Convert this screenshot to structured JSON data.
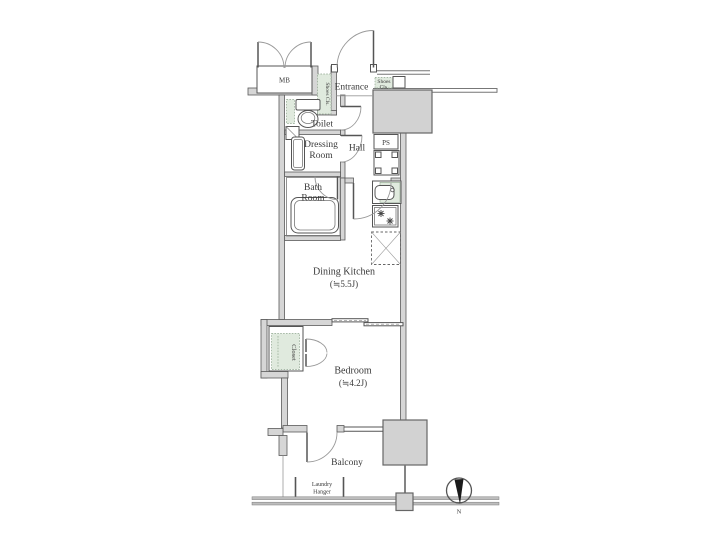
{
  "title": "Apartment floor plan",
  "labels": {
    "mb": "MB",
    "entrance": "Entrance",
    "shoes_left": "Shoes Cls.",
    "shoes_right_1": "Shoes",
    "shoes_right_2": "Cls.",
    "toilet": "Toilet",
    "dressing_1": "Dressing",
    "dressing_2": "Room",
    "hall": "Hall",
    "ps": "PS",
    "bath_1": "Bath",
    "bath_2": "Room",
    "dining_kitchen": "Dining Kitchen",
    "dining_kitchen_size": "(≒5.5J)",
    "closet": "Closet",
    "bedroom": "Bedroom",
    "bedroom_size": "(≒4.2J)",
    "balcony": "Balcony",
    "laundry_1": "Laundry",
    "laundry_2": "Hanger",
    "compass_north": "N"
  },
  "colors": {
    "wall_line": "#5a5a5a",
    "wall_fill": "#d6d6d6",
    "structure_block": "#d2d2d2",
    "closet_green": "#e0eade",
    "text": "#3a3a3a",
    "background": "#ffffff"
  }
}
